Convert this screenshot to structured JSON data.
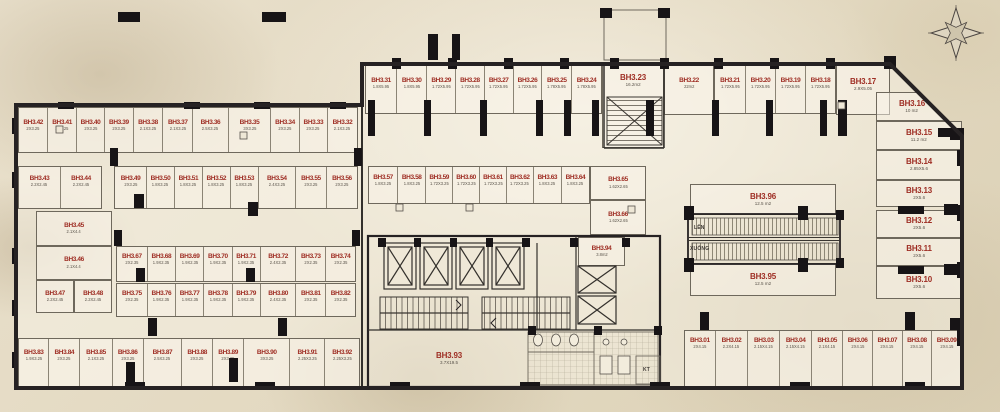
{
  "plan": {
    "escalator_up_label": "LÊN",
    "escalator_down_label": "XUỐNG",
    "kt_label": "KT"
  },
  "colors": {
    "unit_label_red": "#9e2d23",
    "dimension_text": "#5a544b",
    "wall_dark": "#262223",
    "paper": "#e8dfca"
  },
  "rows": {
    "top_mid_left": [
      {
        "id": "BH3.31",
        "dim": "1.8X5.95"
      },
      {
        "id": "BH3.30",
        "dim": "1.8X5.95"
      },
      {
        "id": "BH3.29",
        "dim": "1.72X5.95"
      },
      {
        "id": "BH3.28",
        "dim": "1.72X5.95"
      },
      {
        "id": "BH3.27",
        "dim": "1.72X5.95"
      },
      {
        "id": "BH3.26",
        "dim": "1.72X5.95"
      },
      {
        "id": "BH3.25",
        "dim": "1.78X5.95"
      },
      {
        "id": "BH3.24",
        "dim": "1.78X5.95"
      }
    ],
    "top_mid_right": [
      {
        "id": "BH3.21",
        "dim": "1.72X5.95"
      },
      {
        "id": "BH3.20",
        "dim": "1.72X5.95"
      },
      {
        "id": "BH3.19",
        "dim": "1.72X5.95"
      },
      {
        "id": "BH3.18",
        "dim": "1.72X5.95"
      }
    ],
    "left_row1": [
      {
        "id": "BH3.42",
        "dim": "2X3.25"
      },
      {
        "id": "BH3.41",
        "dim": "2X3.25"
      },
      {
        "id": "BH3.40",
        "dim": "2X3.25"
      },
      {
        "id": "BH3.39",
        "dim": "2X3.25"
      },
      {
        "id": "BH3.38",
        "dim": "2.1X3.25"
      },
      {
        "id": "BH3.37",
        "dim": "2.1X3.25"
      },
      {
        "id": "BH3.36",
        "dim": "2.5X3.25"
      },
      {
        "id": "BH3.35",
        "dim": "3X3.25"
      },
      {
        "id": "BH3.34",
        "dim": "2X3.25"
      },
      {
        "id": "BH3.33",
        "dim": "2X3.25"
      },
      {
        "id": "BH3.32",
        "dim": "2.1X3.25"
      }
    ],
    "left_row2a": [
      {
        "id": "BH3.43",
        "dim": "2.2X2.45"
      },
      {
        "id": "BH3.44",
        "dim": "2.2X2.45"
      }
    ],
    "left_row2b": [
      {
        "id": "BH3.49",
        "dim": "2X3.25"
      },
      {
        "id": "BH3.50",
        "dim": "1.8X3.25"
      },
      {
        "id": "BH3.51",
        "dim": "1.8X3.25"
      },
      {
        "id": "BH3.52",
        "dim": "1.8X3.25"
      },
      {
        "id": "BH3.53",
        "dim": "1.8X3.25"
      },
      {
        "id": "BH3.54",
        "dim": "2.4X3.25"
      },
      {
        "id": "BH3.55",
        "dim": "2X3.25"
      },
      {
        "id": "BH3.56",
        "dim": "2X3.25"
      }
    ],
    "mid_row": [
      {
        "id": "BH3.57",
        "dim": "1.8X3.25"
      },
      {
        "id": "BH3.58",
        "dim": "1.8X3.25"
      },
      {
        "id": "BH3.59",
        "dim": "1.72X3.25"
      },
      {
        "id": "BH3.60",
        "dim": "1.72X3.25"
      },
      {
        "id": "BH3.61",
        "dim": "1.72X3.25"
      },
      {
        "id": "BH3.62",
        "dim": "1.72X3.25"
      },
      {
        "id": "BH3.63",
        "dim": "1.8X3.25"
      },
      {
        "id": "BH3.64",
        "dim": "1.8X3.25"
      }
    ],
    "row3": [
      {
        "id": "BH3.67",
        "dim": "2X2.35"
      },
      {
        "id": "BH3.68",
        "dim": "1.9X2.35"
      },
      {
        "id": "BH3.69",
        "dim": "1.9X2.35"
      },
      {
        "id": "BH3.70",
        "dim": "1.9X2.35"
      },
      {
        "id": "BH3.71",
        "dim": "1.9X2.35"
      },
      {
        "id": "BH3.72",
        "dim": "2.4X2.35"
      },
      {
        "id": "BH3.73",
        "dim": "2X2.35"
      },
      {
        "id": "BH3.74",
        "dim": "2X2.35"
      }
    ],
    "row4": [
      {
        "id": "BH3.75",
        "dim": "2X2.35"
      },
      {
        "id": "BH3.76",
        "dim": "1.9X2.35"
      },
      {
        "id": "BH3.77",
        "dim": "1.9X2.35"
      },
      {
        "id": "BH3.78",
        "dim": "1.9X2.35"
      },
      {
        "id": "BH3.79",
        "dim": "1.9X2.35"
      },
      {
        "id": "BH3.80",
        "dim": "2.4X2.35"
      },
      {
        "id": "BH3.81",
        "dim": "2X2.35"
      },
      {
        "id": "BH3.82",
        "dim": "2X2.35"
      }
    ],
    "bottom_left": [
      {
        "id": "BH3.83",
        "dim": "1.9X3.25"
      },
      {
        "id": "BH3.84",
        "dim": "2X3.25"
      },
      {
        "id": "BH3.85",
        "dim": "2.1X3.25"
      },
      {
        "id": "BH3.86",
        "dim": "2X3.25"
      },
      {
        "id": "BH3.87",
        "dim": "2.5X3.25"
      },
      {
        "id": "BH3.88",
        "dim": "2X3.25"
      },
      {
        "id": "BH3.89",
        "dim": "2X3.25"
      },
      {
        "id": "BH3.90",
        "dim": "3X3.25"
      },
      {
        "id": "BH3.91",
        "dim": "2.25X3.25"
      },
      {
        "id": "BH3.92",
        "dim": "2.25X3.25"
      }
    ],
    "bottom_right": [
      {
        "id": "BH3.01",
        "dim": "2X4.15"
      },
      {
        "id": "BH3.02",
        "dim": "2.2X4.15"
      },
      {
        "id": "BH3.03",
        "dim": "2.15X4.15"
      },
      {
        "id": "BH3.04",
        "dim": "2.15X4.15"
      },
      {
        "id": "BH3.05",
        "dim": "2.1X4.15"
      },
      {
        "id": "BH3.06",
        "dim": "2X4.15"
      },
      {
        "id": "BH3.07",
        "dim": "2X4.15"
      },
      {
        "id": "BH3.08",
        "dim": "2X4.15"
      },
      {
        "id": "BH3.09",
        "dim": "2X4.15"
      }
    ]
  },
  "rooms": [
    {
      "id": "BH3.23",
      "dim": "16.2m2"
    },
    {
      "id": "BH3.22",
      "dim": "22m2"
    },
    {
      "id": "BH3.17",
      "dim": "2.9X5.05"
    },
    {
      "id": "BH3.16",
      "dim": "10 m2"
    },
    {
      "id": "BH3.15",
      "dim": "11.2 m2"
    },
    {
      "id": "BH3.14",
      "dim": "2.85X5.6"
    },
    {
      "id": "BH3.13",
      "dim": "2X5.6"
    },
    {
      "id": "BH3.12",
      "dim": "2X5.6"
    },
    {
      "id": "BH3.11",
      "dim": "2X5.6"
    },
    {
      "id": "BH3.10",
      "dim": "2X5.6"
    },
    {
      "id": "BH3.65",
      "dim": "1.62X2.65"
    },
    {
      "id": "BH3.66",
      "dim": "1.62X2.65"
    },
    {
      "id": "BH3.45",
      "dim": "2.1X4.4"
    },
    {
      "id": "BH3.46",
      "dim": "2.1X4.4"
    },
    {
      "id": "BH3.47",
      "dim": "2.2X2.45"
    },
    {
      "id": "BH3.48",
      "dim": "2.2X2.45"
    },
    {
      "id": "BH3.93",
      "dim": "3.7X19.5"
    },
    {
      "id": "BH3.94",
      "dim": "3.8m2"
    },
    {
      "id": "BH3.96",
      "dim": "12.5 m2"
    },
    {
      "id": "BH3.95",
      "dim": "12.5 m2"
    }
  ]
}
